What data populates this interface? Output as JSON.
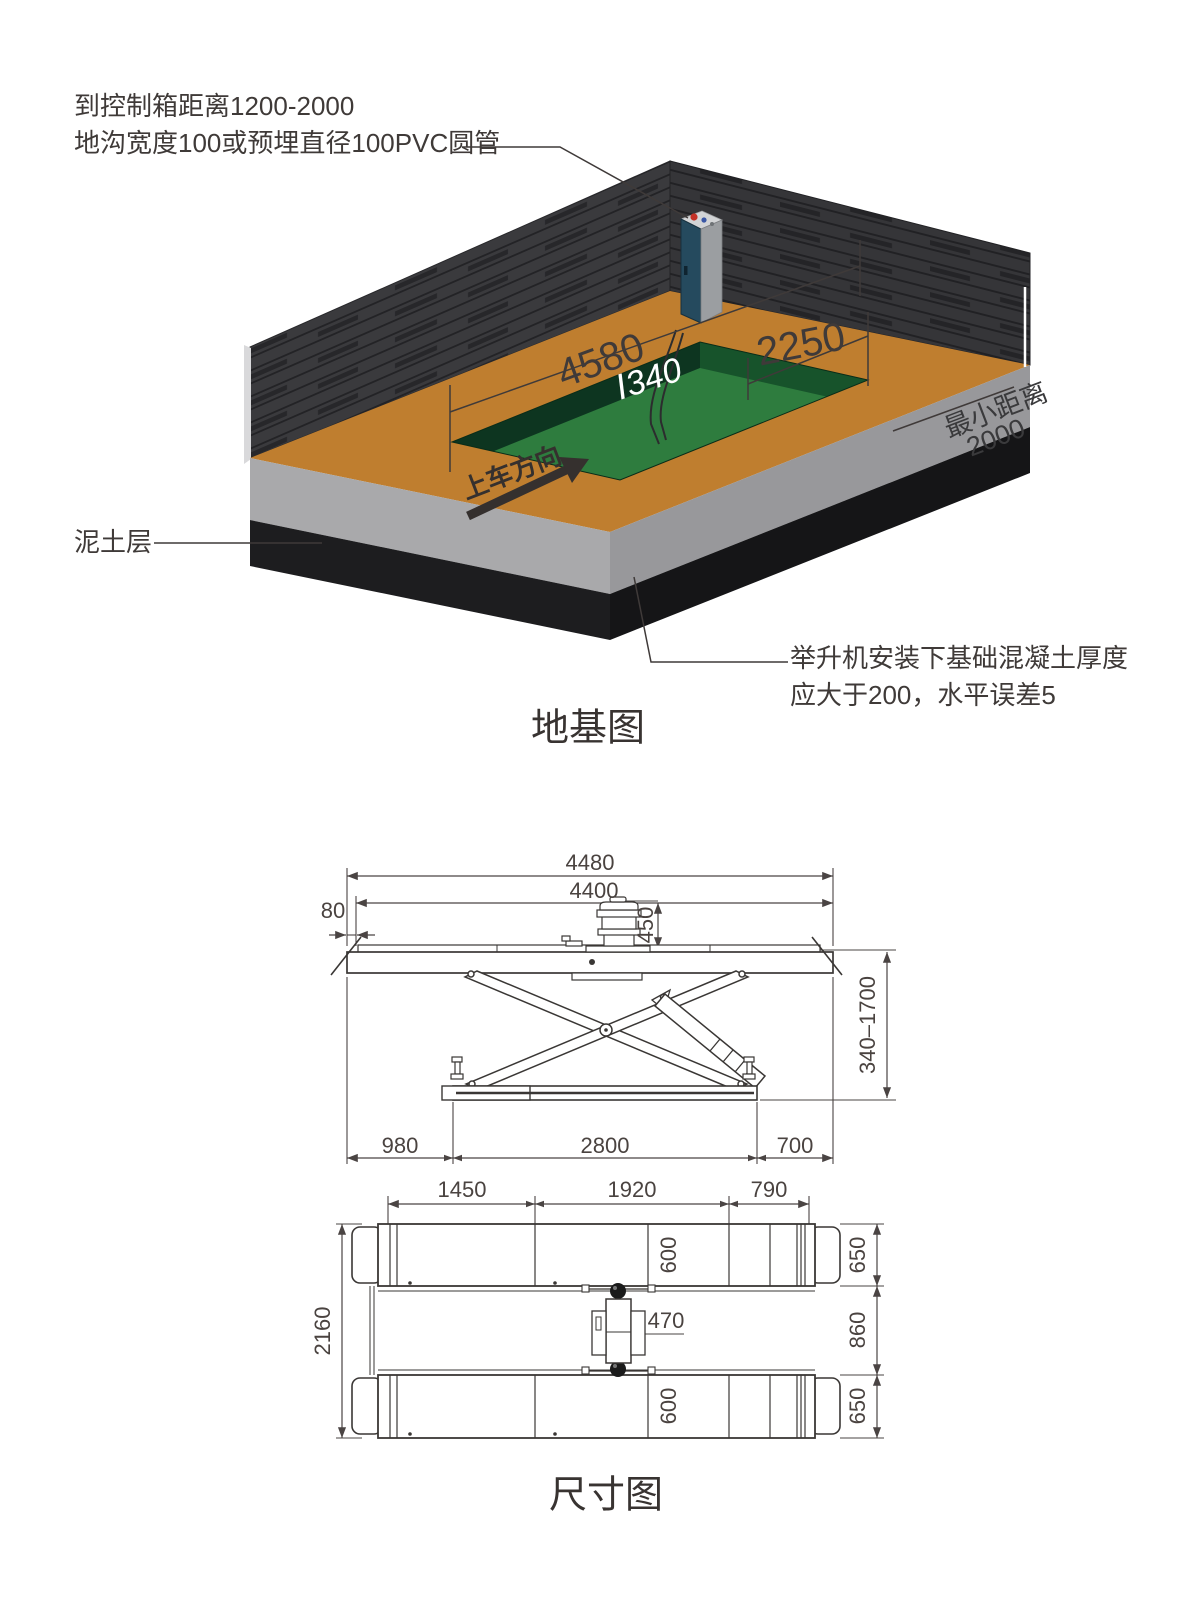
{
  "foundation": {
    "title": "地基图",
    "note_control_line1": "到控制箱距离1200-2000",
    "note_control_line2": "地沟宽度100或预埋直径100PVC圆管",
    "soil_label": "泥土层",
    "concrete_note_line1": "举升机安装下基础混凝土厚度",
    "concrete_note_line2": "应大于200，水平误差5",
    "pit_length": "4580",
    "pit_depth": "Ⅰ340",
    "pit_width": "2250",
    "min_distance_label": "最小距离",
    "min_distance_value": "2000",
    "drive_direction": "上车方向"
  },
  "dimensions": {
    "title": "尺寸图",
    "side_view": {
      "overall_length": "4480",
      "platform_length": "4400",
      "edge_offset": "80",
      "motor_height": "450",
      "lift_height_range": "340–1700",
      "base_left": "980",
      "base_length": "2800",
      "base_right": "700"
    },
    "plan_view": {
      "segment_left": "1450",
      "segment_mid": "1920",
      "segment_right": "790",
      "overall_width": "2160",
      "track_width_top": "600",
      "track_width_bottom": "600",
      "unit_width": "470",
      "right_top": "650",
      "right_mid": "860",
      "right_bottom": "650"
    }
  }
}
